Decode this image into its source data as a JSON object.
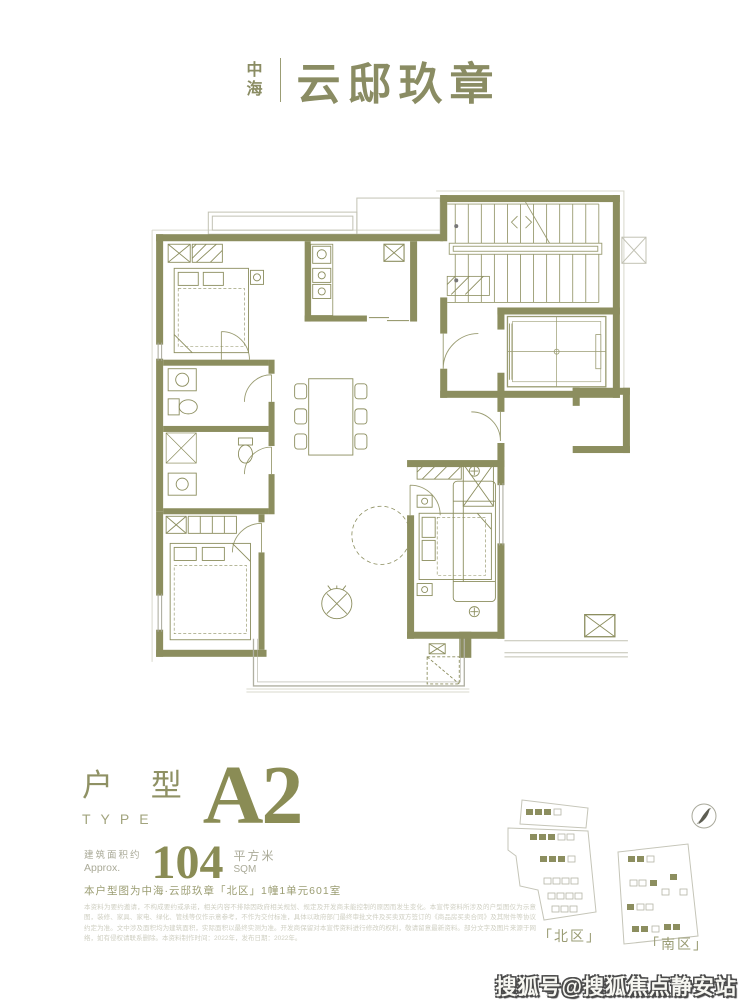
{
  "page": {
    "background": "#ffffff",
    "accent": "#8C8E5F"
  },
  "logo": {
    "brand_vertical": "中海",
    "brand_main": "云邸玖章"
  },
  "unit": {
    "type_label_cn": "户 型",
    "type_label_en": "TYPE",
    "type_code": "A2",
    "area_prefix_cn": "建筑面积约",
    "area_prefix_en": "Approx.",
    "area_value": "104",
    "area_unit_cn": "平方米",
    "area_unit_en": "SQM",
    "location_note": "本户型图为中海·云邸玖章「北区」1幢1单元601室",
    "disclaimer": "本资料为要约邀请，不构成要约或承诺，相关内容不排除因政府相关规划、规定及开发商未能控制的原因而发生变化。本宣传资料所涉及的户型图仅为示意图，装修、家具、家电、绿化、管线等仅作示意参考，不作为交付标准，具体以政府部门最终审批文件及买卖双方签订的《商品房买卖合同》及其附件等协议约定为准。文中涉及面积均为建筑面积，实际面积以最终实测为准。开发商保留对本宣传资料进行修改的权利，敬请留意最新资料。部分文字及图片来源于网络，如有侵权请联系删除。本资料制作时间：2022年，发布日期：2022年。"
  },
  "siteplan": {
    "north_label": "「北区」",
    "south_label": "「南区」",
    "compass_icon": "north-compass"
  },
  "watermark": {
    "text": "搜狐号@搜狐焦点静安站"
  }
}
